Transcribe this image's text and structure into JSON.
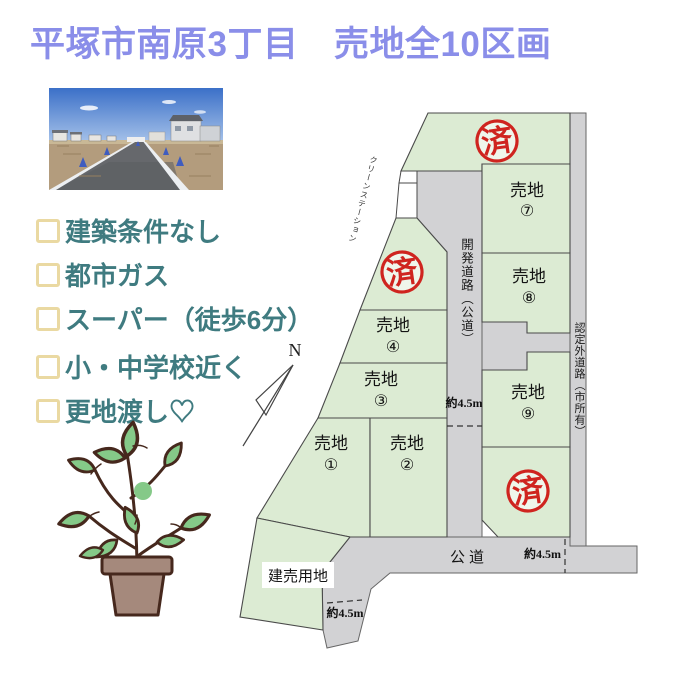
{
  "title": "平塚市南原3丁目　売地全10区画",
  "checklist": {
    "items": [
      {
        "label": "建築条件なし"
      },
      {
        "label": "都市ガス"
      },
      {
        "label": "スーパー（徒歩6分）"
      },
      {
        "label": "小・中学校近く"
      },
      {
        "label": "更地渡し♡"
      }
    ]
  },
  "map": {
    "north_label": "N",
    "clean_station_label": "クリーンステーション",
    "dev_road_label": "開発道路（公道）",
    "outer_road_label": "認定外道路（市所有）",
    "public_road_label": "公道",
    "dimension_label": "約4.5m",
    "tateuri_label": "建売用地",
    "sold_stamp": "済",
    "plots": [
      {
        "name": "売地",
        "num": "①"
      },
      {
        "name": "売地",
        "num": "②"
      },
      {
        "name": "売地",
        "num": "③"
      },
      {
        "name": "売地",
        "num": "④"
      },
      {
        "name": "売地",
        "num": "⑦"
      },
      {
        "name": "売地",
        "num": "⑧"
      },
      {
        "name": "売地",
        "num": "⑨"
      }
    ]
  },
  "colors": {
    "title": "#8a8ee9",
    "checklist_text": "#3f7b80",
    "checkbox_border": "#ead9a2",
    "plot_green": "#dcebd3",
    "road_gray": "#d2d2d4",
    "stamp_red": "#cf241f"
  }
}
